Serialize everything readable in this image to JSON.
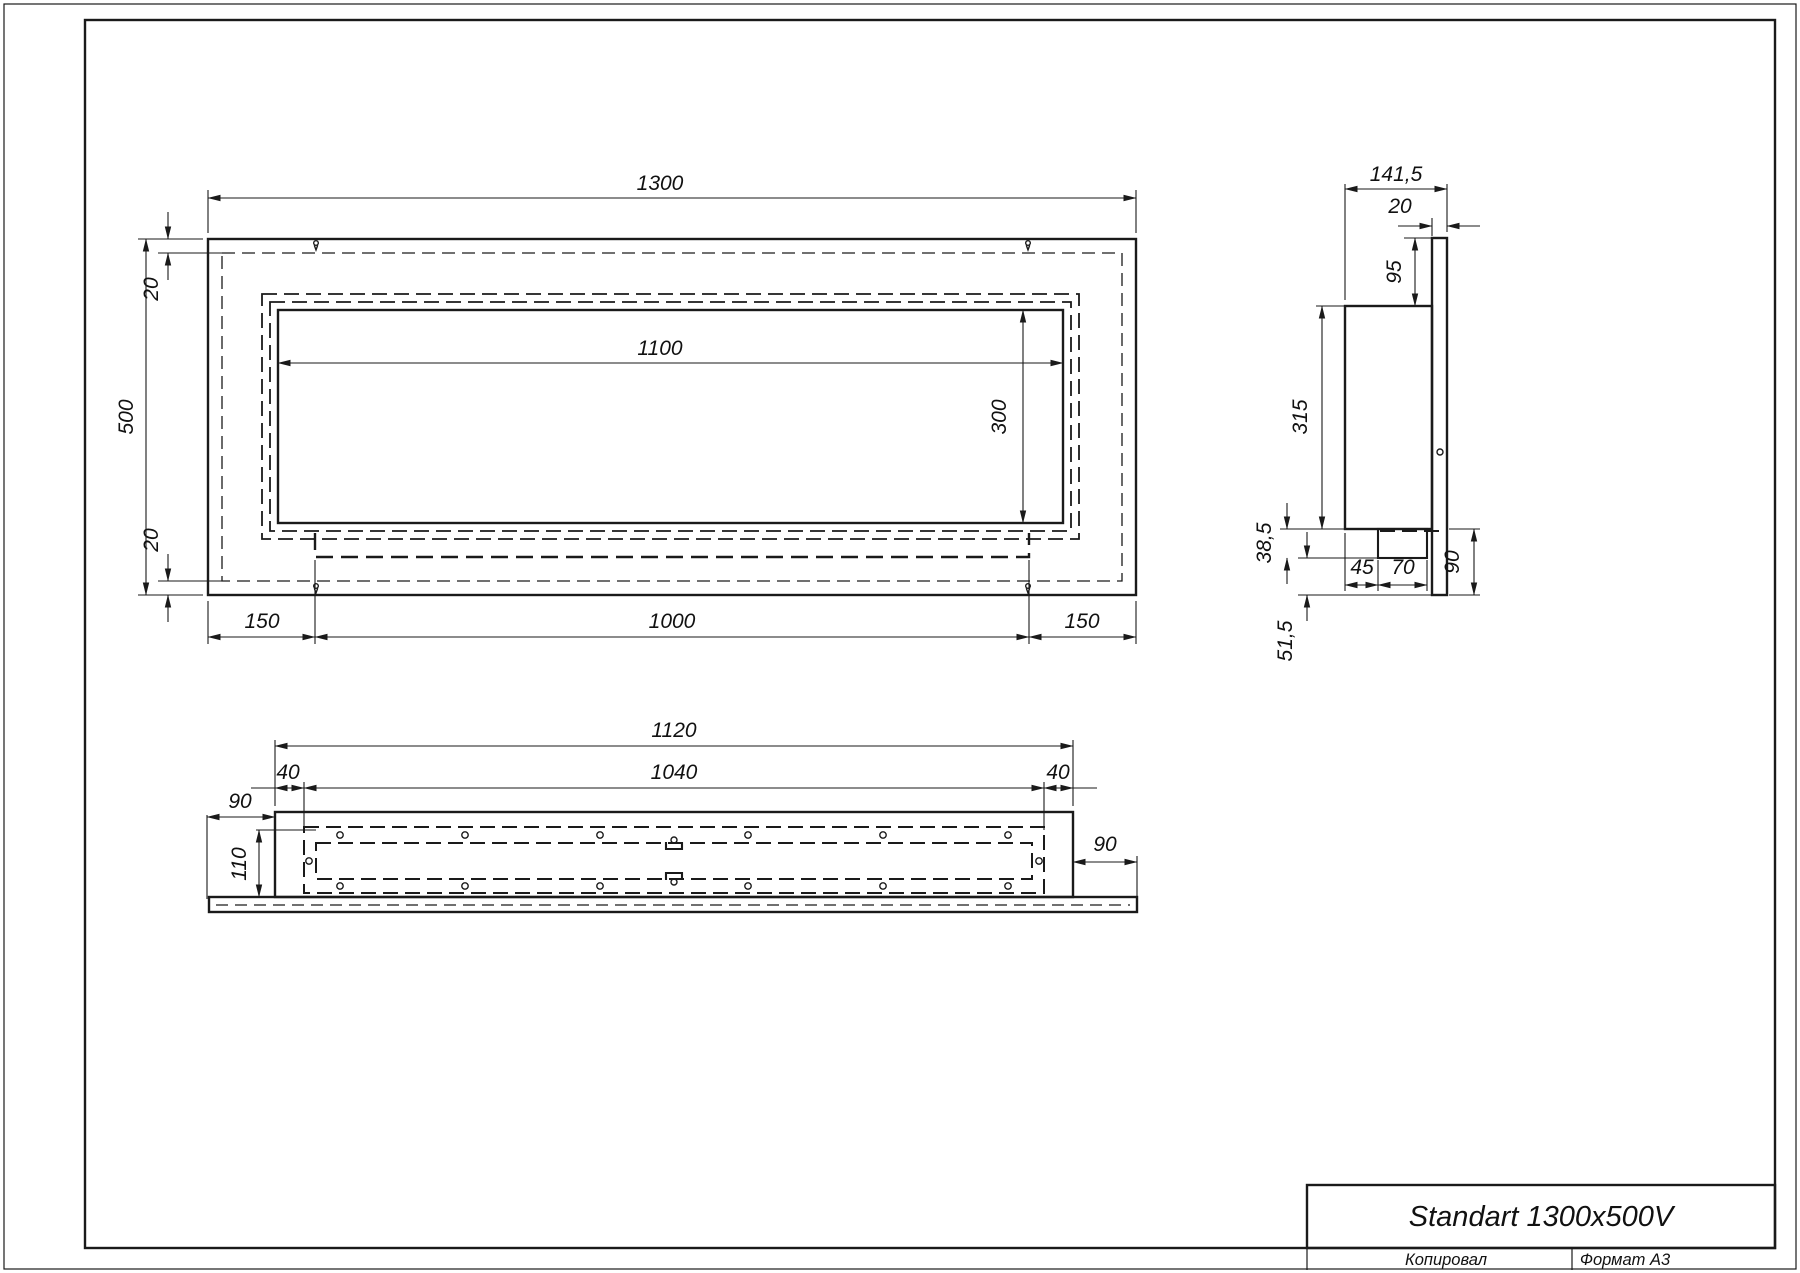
{
  "sheet": {
    "format_label": "Формат А3",
    "copied_label": "Копировал",
    "line_color": "#1a1a1a",
    "background": "#ffffff"
  },
  "title_block": {
    "title": "Standart 1300x500V"
  },
  "views": {
    "front": {
      "width": "1300",
      "height": "500",
      "inset_top": "20",
      "inset_bottom": "20",
      "opening_width": "1100",
      "opening_height": "300",
      "tray_offset_left": "150",
      "tray_width": "1000",
      "tray_offset_right": "150"
    },
    "side": {
      "depth": "141,5",
      "flange_thickness": "20",
      "top_to_body": "95",
      "body_height": "315",
      "tray_drop": "38,5",
      "tray_setback": "45",
      "tray_depth": "70",
      "below_tray": "51,5",
      "flange_below_body": "90"
    },
    "bottom": {
      "body_width": "1120",
      "opening_width": "1040",
      "margin_left": "40",
      "margin_right": "40",
      "flange_ext_left": "90",
      "body_depth": "110",
      "flange_ext_right": "90"
    }
  }
}
